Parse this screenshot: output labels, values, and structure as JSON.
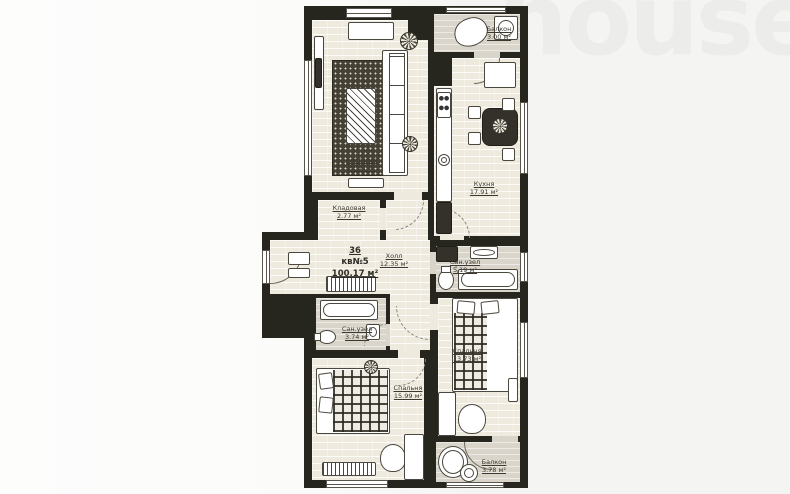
{
  "watermark": {
    "text": "house.kg"
  },
  "unit": {
    "building_no": "36",
    "apartment_no": "кв№5",
    "total_area": "100.17 м²"
  },
  "rooms": {
    "living_room": {
      "name": "Гостиная",
      "area": "21.71 м²"
    },
    "kitchen": {
      "name": "Кухня",
      "area": "17.91 м²"
    },
    "balcony_top": {
      "name": "Балкон",
      "area": "3.00 м²"
    },
    "storage": {
      "name": "Кладовая",
      "area": "2.77 м²"
    },
    "hall": {
      "name": "Холл",
      "area": "12.35 м²"
    },
    "bathroom_main": {
      "name": "Сан.узел",
      "area": "5.19 м²"
    },
    "bathroom_small": {
      "name": "Сан.узел",
      "area": "3.74 м²"
    },
    "bedroom_large": {
      "name": "Спальня",
      "area": "15.99 м²"
    },
    "bedroom_small": {
      "name": "Спальня",
      "area": "13.73 м²"
    },
    "balcony_bottom": {
      "name": "Балкон",
      "area": "3.78 м²"
    }
  },
  "colors": {
    "wall": "#26251e",
    "floor": "#efeade",
    "wet_floor": "#dad5ca",
    "watermark": "#ececea",
    "background": "#f7f7f5"
  }
}
